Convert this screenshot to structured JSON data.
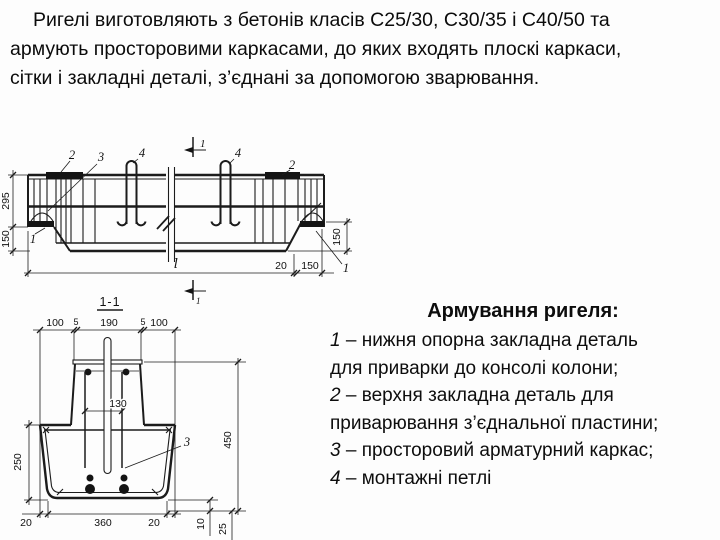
{
  "intro": {
    "lines": [
      "Ригелі виготовляють з бетонів класів С25/30, С30/35 і С40/50 та",
      "армують просторовими каркасами, до яких входять плоскі каркаси,",
      "сітки і закладні деталі, з’єднані за допомогою зварювання."
    ]
  },
  "legend": {
    "title": "Армування ригеля:",
    "lines": [
      "1 – нижня опорна закладна деталь",
      "для приварки до консолі колони;",
      "2 – верхня закладна деталь для",
      "приварювання з’єднальної пластини;",
      "3 – просторовий арматурний каркас;",
      "4 – монтажні петлі"
    ]
  },
  "drawing": {
    "section_cut_label": "1",
    "length_symbol": "l",
    "long_section": {
      "dim_height_upper": "295",
      "dim_height_end": "150",
      "dim_end_gap": "20",
      "dim_bearing_length": "150",
      "dim_end_height": "150",
      "callout_top_plate": "2",
      "callout_cage": "3",
      "callout_loop": "4",
      "callout_bottom_plate": "1"
    },
    "cross_section": {
      "title": "1-1",
      "dims_top": [
        "100",
        "5",
        "190",
        "5",
        "100"
      ],
      "dim_bar_spacing": "130",
      "dim_flange_height": "250",
      "dim_total_height": "450",
      "dims_bottom": [
        "20",
        "360",
        "20"
      ],
      "dim_cover_1": "10",
      "dim_cover_2": "25",
      "callout_cage": "3"
    }
  },
  "colors": {
    "background": "#fdfdfd",
    "ink": "#111111",
    "line": "#1c1c1c"
  }
}
